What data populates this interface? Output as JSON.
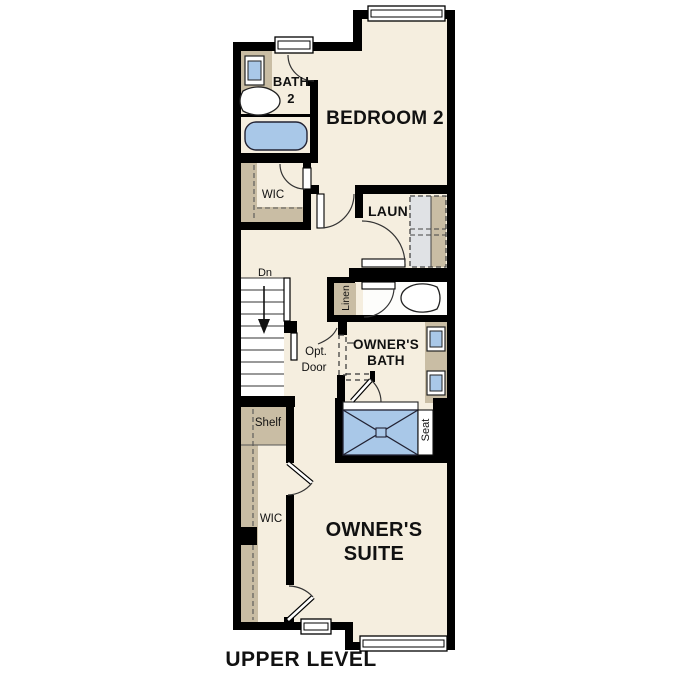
{
  "plan": {
    "title": "UPPER LEVEL",
    "type": "floor-plan"
  },
  "labels": {
    "bath2_1": "BATH",
    "bath2_2": "2",
    "bedroom2": "BEDROOM 2",
    "wic_upper": "WIC",
    "laundry": "LAUN",
    "dn": "Dn",
    "linen": "Linen",
    "opt_1": "Opt.",
    "opt_2": "Door",
    "owners_bath_1": "OWNER'S",
    "owners_bath_2": "BATH",
    "shelf": "Shelf",
    "seat": "Seat",
    "wic_lower": "WIC",
    "owners_suite_1": "OWNER'S",
    "owners_suite_2": "SUITE",
    "title": "UPPER LEVEL"
  },
  "colors": {
    "wall": "#000000",
    "floor": "#f5eedf",
    "casework_tan": "#c9bda4",
    "fixture_blue": "#a9c8e8",
    "appliance_gray": "#e0e2e5",
    "text": "#111111",
    "background": "#ffffff"
  }
}
